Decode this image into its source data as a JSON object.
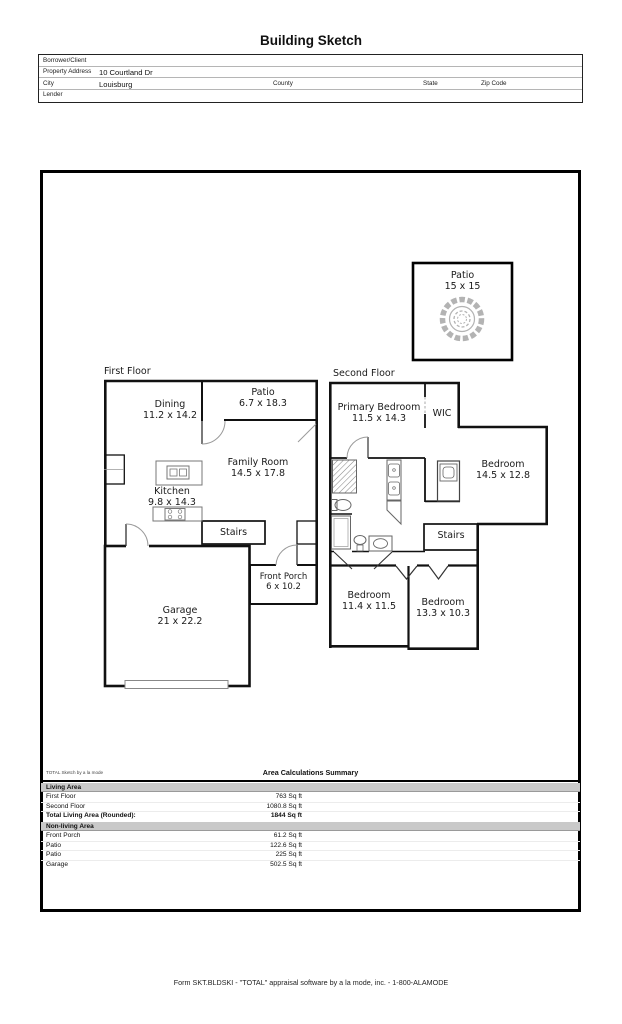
{
  "title": "Building Sketch",
  "form": {
    "borrower_label": "Borrower/Client",
    "property_label": "Property Address",
    "property_value": "10 Courtland Dr",
    "city_label": "City",
    "city_value": "Louisburg",
    "county_label": "County",
    "state_label": "State",
    "zip_label": "Zip Code",
    "lender_label": "Lender"
  },
  "sketch": {
    "detached_patio": {
      "name": "Patio",
      "dims": "15 x 15"
    },
    "first_floor": {
      "title": "First Floor",
      "dining": {
        "name": "Dining",
        "dims": "11.2 x 14.2"
      },
      "patio": {
        "name": "Patio",
        "dims": "6.7 x 18.3"
      },
      "family_room": {
        "name": "Family Room",
        "dims": "14.5 x 17.8"
      },
      "kitchen": {
        "name": "Kitchen",
        "dims": "9.8 x 14.3"
      },
      "stairs": "Stairs",
      "garage": {
        "name": "Garage",
        "dims": "21 x 22.2"
      },
      "front_porch": {
        "name": "Front Porch",
        "dims": "6 x 10.2"
      }
    },
    "second_floor": {
      "title": "Second Floor",
      "primary_bedroom": {
        "name": "Primary Bedroom",
        "dims": "11.5 x 14.3"
      },
      "wic": "WIC",
      "bedroom_right": {
        "name": "Bedroom",
        "dims": "14.5 x 12.8"
      },
      "stairs": "Stairs",
      "bedroom_left": {
        "name": "Bedroom",
        "dims": "11.4 x 11.5"
      },
      "bedroom_center": {
        "name": "Bedroom",
        "dims": "13.3 x 10.3"
      }
    }
  },
  "summary": {
    "watermark": "TOTAL Sketch by a la mode",
    "title": "Area Calculations Summary",
    "living_header": "Living Area",
    "living_rows": [
      {
        "label": "First Floor",
        "value": "763 Sq ft"
      },
      {
        "label": "Second Floor",
        "value": "1080.8 Sq ft"
      },
      {
        "label": "Total Living Area (Rounded):",
        "value": "1844 Sq ft"
      }
    ],
    "nonliving_header": "Non-living Area",
    "nonliving_rows": [
      {
        "label": "Front Porch",
        "value": "61.2 Sq ft"
      },
      {
        "label": "Patio",
        "value": "122.6 Sq ft"
      },
      {
        "label": "Patio",
        "value": "225 Sq ft"
      },
      {
        "label": "Garage",
        "value": "502.5 Sq ft"
      }
    ]
  },
  "footer": "Form SKT.BLDSKI - \"TOTAL\" appraisal software by a la mode, inc. - 1-800-ALAMODE"
}
